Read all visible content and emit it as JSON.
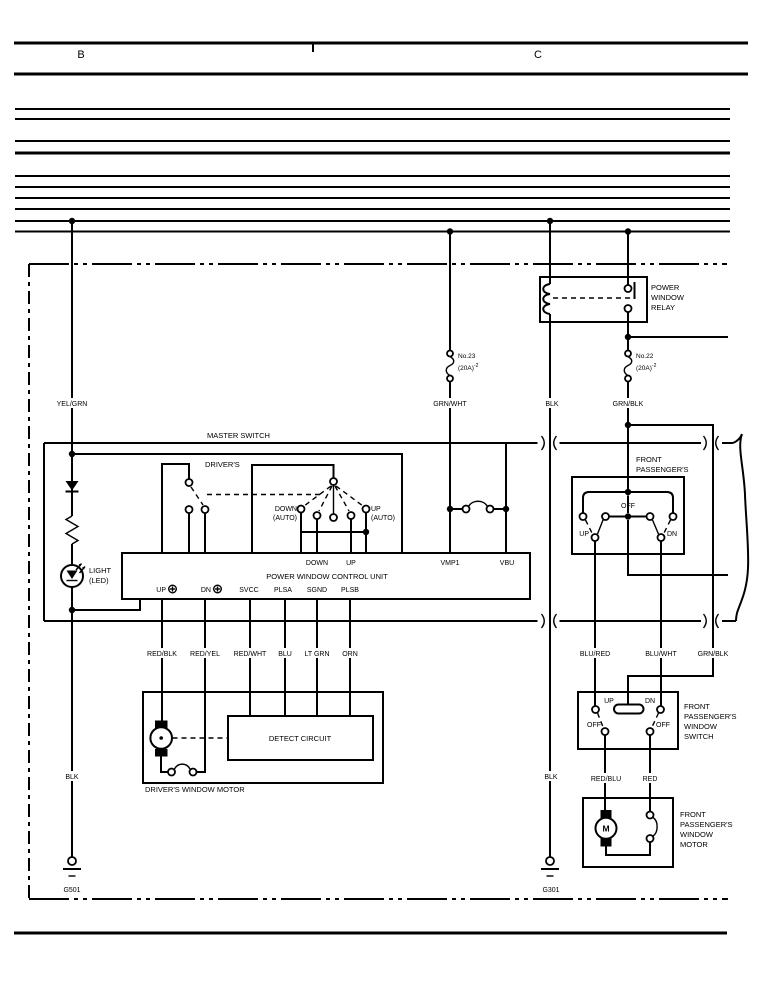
{
  "header": {
    "b": "B",
    "c": "C"
  },
  "relay": {
    "l1": "POWER",
    "l2": "WINDOW",
    "l3": "RELAY"
  },
  "fuse23": {
    "name": "No.23",
    "rating": "(20A)",
    "sup": "-2"
  },
  "fuse22": {
    "name": "No.22",
    "rating": "(20A)",
    "sup": "-2"
  },
  "wires": {
    "yel_grn": "YEL/GRN",
    "grn_wht": "GRN/WHT",
    "blk_mid": "BLK",
    "grn_blk": "GRN/BLK",
    "red_blk": "RED/BLK",
    "red_yel": "RED/YEL",
    "red_wht": "RED/WHT",
    "blu": "BLU",
    "lt_grn": "LT GRN",
    "orn": "ORN",
    "blk_left": "BLK",
    "blk_right": "BLK",
    "blu_red": "BLU/RED",
    "blu_wht": "BLU/WHT",
    "grn_blk2": "GRN/BLK",
    "red_blu": "RED/BLU",
    "red": "RED"
  },
  "master": {
    "title": "MASTER SWITCH",
    "drivers": "DRIVER'S",
    "down": "DOWN",
    "down_auto": "(AUTO)",
    "up": "UP",
    "up_auto": "(AUTO)",
    "light1": "LIGHT",
    "light2": "(LED)"
  },
  "cu": {
    "title": "POWER WINDOW CONTROL UNIT",
    "down": "DOWN",
    "up": "UP",
    "vmp1": "VMP1",
    "vbu": "VBU",
    "up2": "UP",
    "dn": "DN",
    "svcc": "SVCC",
    "plsa": "PLSA",
    "sgnd": "SGND",
    "plsb": "PLSB"
  },
  "pass_sec": {
    "l1": "FRONT",
    "l2": "PASSENGER'S",
    "off": "OFF",
    "up": "UP",
    "dn": "DN"
  },
  "dmotor": {
    "label": "DRIVER'S WINDOW MOTOR",
    "detect": "DETECT CIRCUIT"
  },
  "psw": {
    "up": "UP",
    "dn": "DN",
    "off1": "OFF",
    "off2": "OFF",
    "l1": "FRONT",
    "l2": "PASSENGER'S",
    "l3": "WINDOW",
    "l4": "SWITCH"
  },
  "pmotor": {
    "m": "M",
    "l1": "FRONT",
    "l2": "PASSENGER'S",
    "l3": "WINDOW",
    "l4": "MOTOR"
  },
  "gnd": {
    "g501": "G501",
    "g301": "G301"
  }
}
